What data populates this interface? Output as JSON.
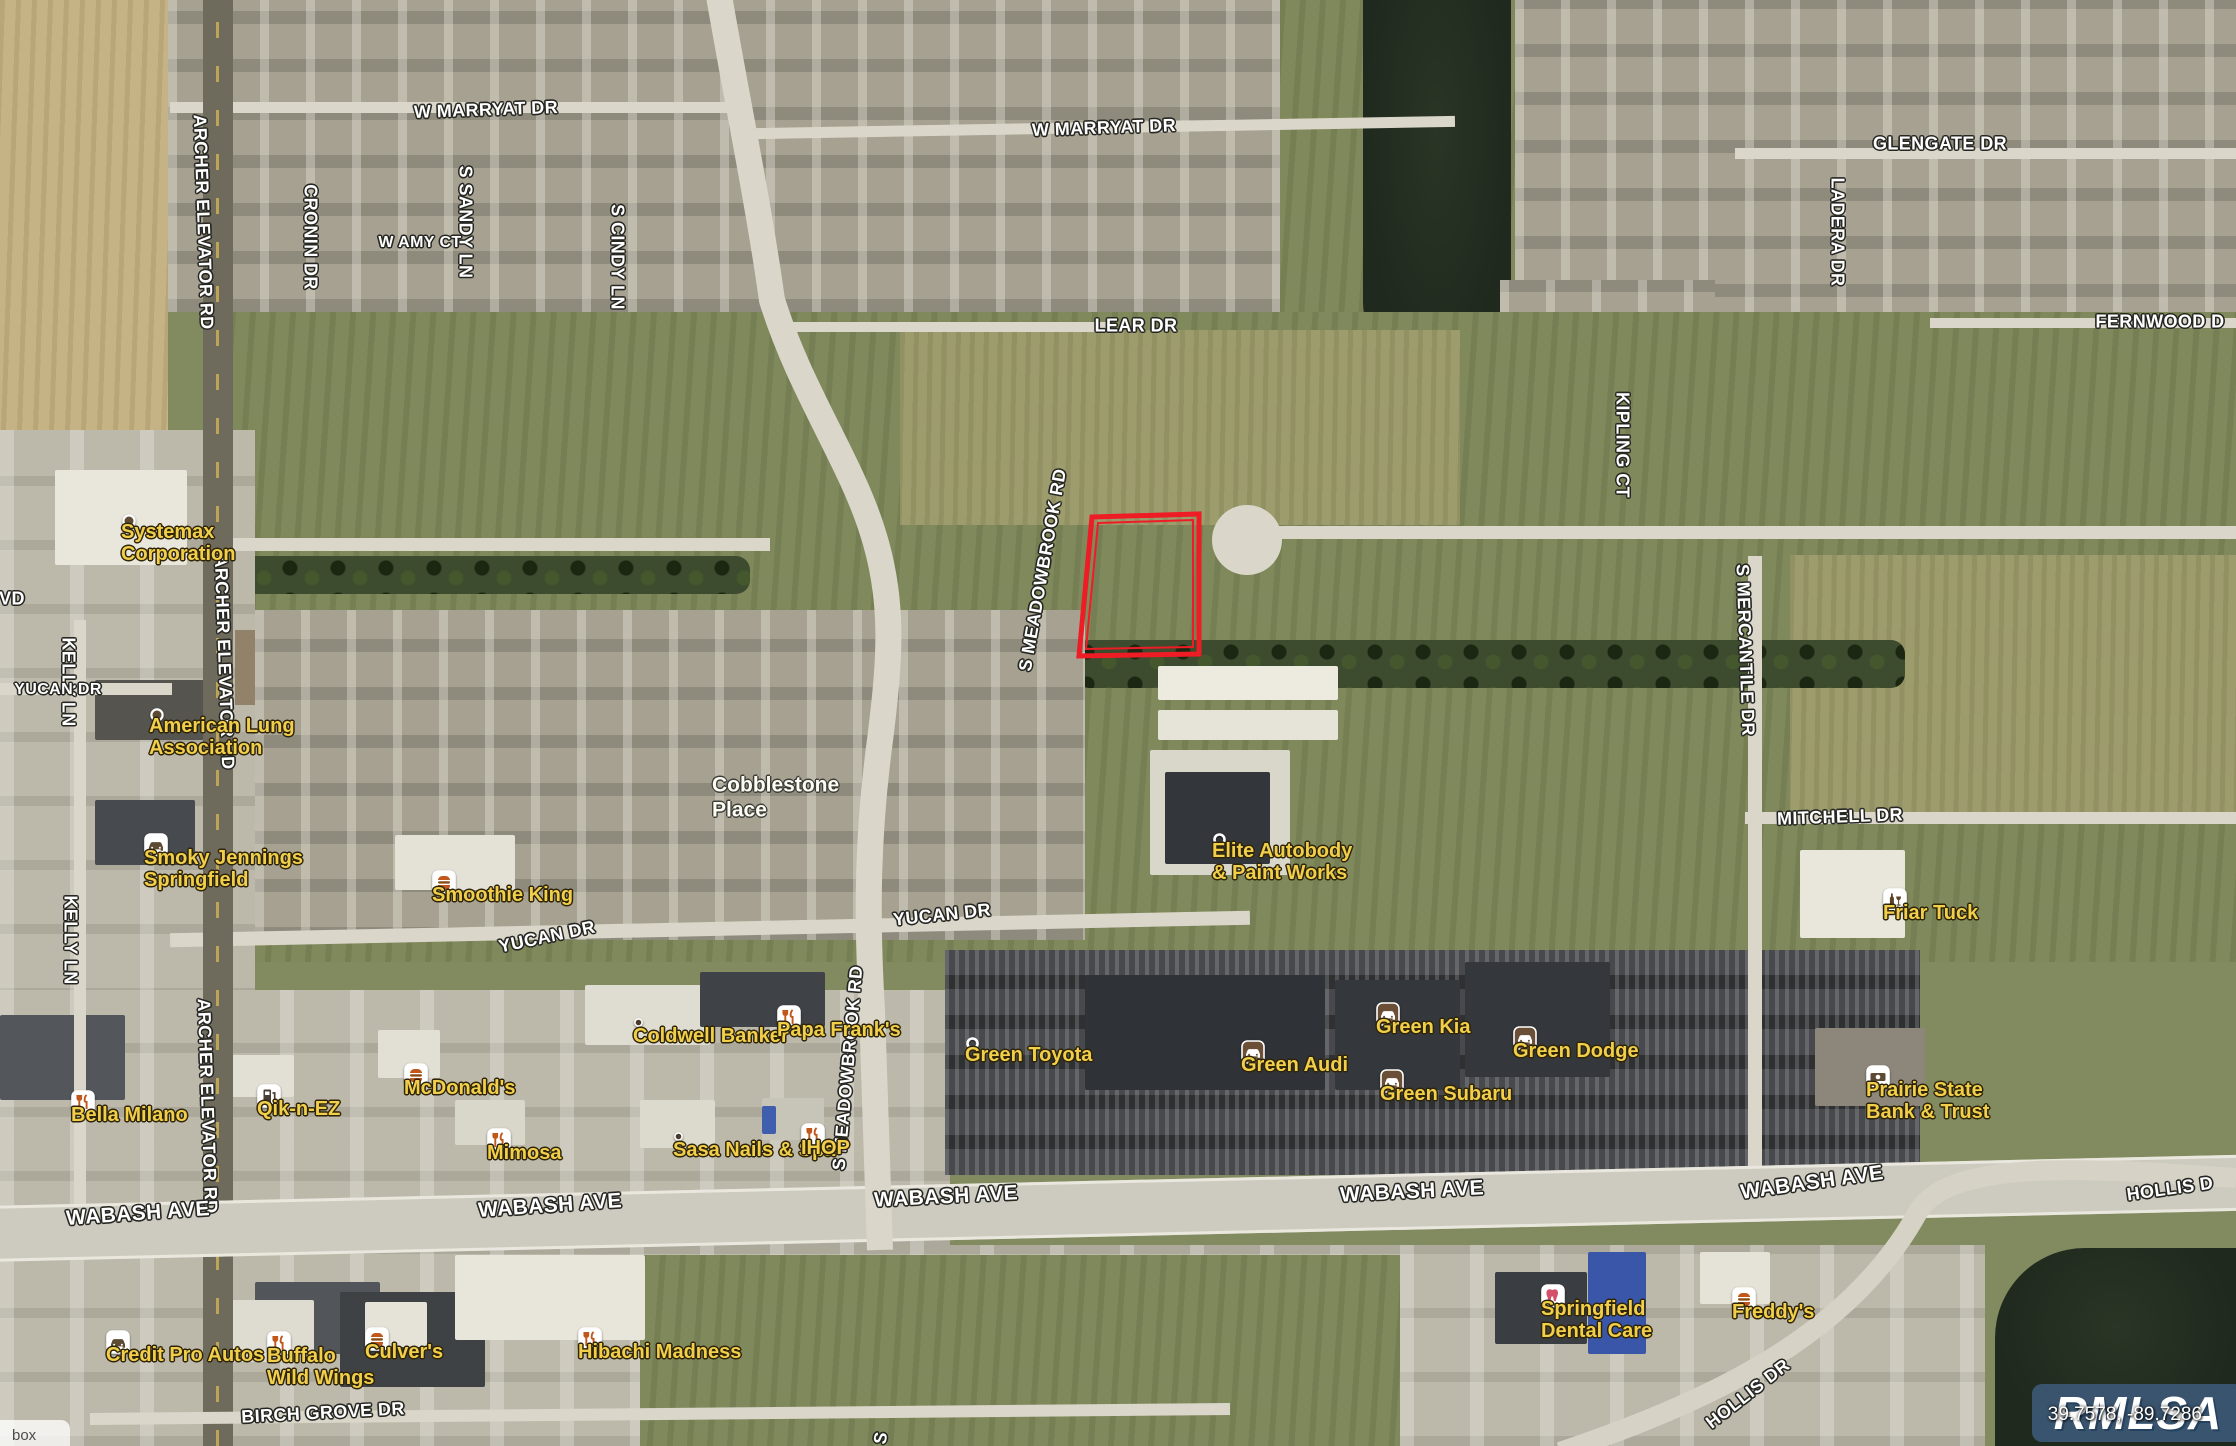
{
  "map": {
    "street_labels": [
      {
        "text": "W MARRYAT DR",
        "x": 486,
        "y": 110,
        "rot": -2
      },
      {
        "text": "W MARRYAT DR",
        "x": 1104,
        "y": 128,
        "rot": -2
      },
      {
        "text": "GLENGATE DR",
        "x": 1940,
        "y": 144,
        "rot": 0
      },
      {
        "text": "LEAR DR",
        "x": 1136,
        "y": 326,
        "rot": 0
      },
      {
        "text": "FERNWOOD D",
        "x": 2160,
        "y": 322,
        "rot": 0
      },
      {
        "text": "CRONIN DR",
        "x": 310,
        "y": 237,
        "rot": 90
      },
      {
        "text": "S SANDY LN",
        "x": 465,
        "y": 222,
        "rot": 90
      },
      {
        "text": "S CINDY LN",
        "x": 617,
        "y": 257,
        "rot": 90
      },
      {
        "text": "W AMY CT",
        "x": 420,
        "y": 243,
        "rot": 0,
        "size": 16
      },
      {
        "text": "ARCHER ELEVATOR RD",
        "x": 203,
        "y": 222,
        "rot": 88
      },
      {
        "text": "ARCHER ELEVATOR RD",
        "x": 224,
        "y": 662,
        "rot": 88
      },
      {
        "text": "ARCHER ELEVATOR RD",
        "x": 207,
        "y": 1106,
        "rot": 88
      },
      {
        "text": "KELLY LN",
        "x": 68,
        "y": 682,
        "rot": 90
      },
      {
        "text": "KELLY LN",
        "x": 70,
        "y": 940,
        "rot": 90
      },
      {
        "text": "VD",
        "x": 12,
        "y": 599,
        "rot": 0
      },
      {
        "text": "KIPLING CT",
        "x": 1622,
        "y": 445,
        "rot": 90
      },
      {
        "text": "LADERA DR",
        "x": 1837,
        "y": 232,
        "rot": 90
      },
      {
        "text": "S MERCANTILE DR",
        "x": 1745,
        "y": 650,
        "rot": 88
      },
      {
        "text": "S MEADOWBROOK RD",
        "x": 1043,
        "y": 570,
        "rot": -80
      },
      {
        "text": "S MEADOWBROOK RD",
        "x": 848,
        "y": 1068,
        "rot": -85
      },
      {
        "text": "S",
        "x": 881,
        "y": 1438,
        "rot": -80
      },
      {
        "text": "MITCHELL DR",
        "x": 1840,
        "y": 817,
        "rot": -2
      },
      {
        "text": "YUCAN DR",
        "x": 58,
        "y": 690,
        "rot": 0,
        "size": 16
      },
      {
        "text": "YUCAN DR",
        "x": 547,
        "y": 937,
        "rot": -12
      },
      {
        "text": "YUCAN DR",
        "x": 942,
        "y": 915,
        "rot": -6
      },
      {
        "text": "WABASH AVE",
        "x": 138,
        "y": 1214,
        "rot": -4,
        "size": 21
      },
      {
        "text": "WABASH AVE",
        "x": 550,
        "y": 1206,
        "rot": -4,
        "size": 21
      },
      {
        "text": "WABASH AVE",
        "x": 946,
        "y": 1197,
        "rot": -3,
        "size": 21
      },
      {
        "text": "WABASH AVE",
        "x": 1412,
        "y": 1192,
        "rot": -3,
        "size": 21
      },
      {
        "text": "WABASH AVE",
        "x": 1812,
        "y": 1183,
        "rot": -8,
        "size": 21
      },
      {
        "text": "BIRCH GROVE DR",
        "x": 323,
        "y": 1413,
        "rot": -3
      },
      {
        "text": "HOLLIS DR",
        "x": 1748,
        "y": 1394,
        "rot": -38
      },
      {
        "text": "HOLLIS D",
        "x": 2170,
        "y": 1189,
        "rot": -8
      }
    ],
    "area_labels": [
      {
        "lines": [
          "Cobblestone",
          "Place"
        ],
        "x": 712,
        "y": 785
      }
    ],
    "poi_labels": [
      {
        "lines": [
          "Systemax",
          "Corporation"
        ],
        "x": 121,
        "y": 513,
        "icon": "dot"
      },
      {
        "lines": [
          "American Lung",
          "Association"
        ],
        "x": 149,
        "y": 707,
        "icon": "dot"
      },
      {
        "lines": [
          "Smoky Jennings",
          "Springfield"
        ],
        "x": 144,
        "y": 833,
        "icon": "car-light"
      },
      {
        "lines": [
          "Smoothie King"
        ],
        "x": 432,
        "y": 870,
        "icon": "burger"
      },
      {
        "lines": [
          "Elite Autobody",
          "& Paint Works"
        ],
        "x": 1212,
        "y": 832,
        "icon": "ring"
      },
      {
        "lines": [
          "Friar Tuck"
        ],
        "x": 1883,
        "y": 888,
        "icon": "bar"
      },
      {
        "lines": [
          "Coldwell Banker"
        ],
        "x": 633,
        "y": 1017,
        "icon": "smalldot"
      },
      {
        "lines": [
          "Papa Frank's"
        ],
        "x": 777,
        "y": 1005,
        "icon": "restaurant"
      },
      {
        "lines": [
          "Green Toyota"
        ],
        "x": 965,
        "y": 1036,
        "icon": "ring"
      },
      {
        "lines": [
          "Green Audi"
        ],
        "x": 1241,
        "y": 1040,
        "icon": "car-dark"
      },
      {
        "lines": [
          "Green Kia"
        ],
        "x": 1376,
        "y": 1002,
        "icon": "car-dark"
      },
      {
        "lines": [
          "Green Subaru"
        ],
        "x": 1380,
        "y": 1069,
        "icon": "car-dark"
      },
      {
        "lines": [
          "Green Dodge"
        ],
        "x": 1513,
        "y": 1026,
        "icon": "car-dark"
      },
      {
        "lines": [
          "Prairie State",
          "Bank & Trust"
        ],
        "x": 1866,
        "y": 1065,
        "icon": "bank"
      },
      {
        "lines": [
          "Bella Milano"
        ],
        "x": 71,
        "y": 1090,
        "icon": "restaurant"
      },
      {
        "lines": [
          "Qik-n-EZ"
        ],
        "x": 257,
        "y": 1084,
        "icon": "fuel"
      },
      {
        "lines": [
          "McDonald's"
        ],
        "x": 404,
        "y": 1063,
        "icon": "burger"
      },
      {
        "lines": [
          "Mimosa"
        ],
        "x": 487,
        "y": 1128,
        "icon": "restaurant"
      },
      {
        "lines": [
          "Sasa Nails & Spa"
        ],
        "x": 673,
        "y": 1131,
        "icon": "smalldot"
      },
      {
        "lines": [
          "IHOP"
        ],
        "x": 801,
        "y": 1123,
        "icon": "restaurant"
      },
      {
        "lines": [
          "Credit Pro Autos"
        ],
        "x": 106,
        "y": 1330,
        "icon": "car-light"
      },
      {
        "lines": [
          "Buffalo",
          "Wild Wings"
        ],
        "x": 267,
        "y": 1331,
        "icon": "restaurant"
      },
      {
        "lines": [
          "Culver's"
        ],
        "x": 365,
        "y": 1327,
        "icon": "burger"
      },
      {
        "lines": [
          "Hibachi Madness"
        ],
        "x": 578,
        "y": 1327,
        "icon": "restaurant"
      },
      {
        "lines": [
          "Springfield",
          "Dental Care"
        ],
        "x": 1541,
        "y": 1284,
        "icon": "tooth"
      },
      {
        "lines": [
          "Freddy's"
        ],
        "x": 1732,
        "y": 1287,
        "icon": "burger"
      }
    ]
  },
  "parcel": {
    "outline_color": "#ee1c25",
    "points": [
      [
        1092,
        517
      ],
      [
        1199,
        514
      ],
      [
        1199,
        654
      ],
      [
        1079,
        656
      ]
    ],
    "inner_points": [
      [
        1098,
        523
      ],
      [
        1193,
        520
      ],
      [
        1193,
        647
      ],
      [
        1086,
        649
      ]
    ]
  },
  "watermark": {
    "logo": "RMLSA",
    "coordinates": "39.7578, -89.7286",
    "box_color": "#3e5a7a"
  },
  "attribution": "box",
  "colors": {
    "street_label": "#ffffff",
    "poi_label": "#f1cf4b",
    "parcel_outline": "#ee1c25",
    "water": "#22301f"
  }
}
